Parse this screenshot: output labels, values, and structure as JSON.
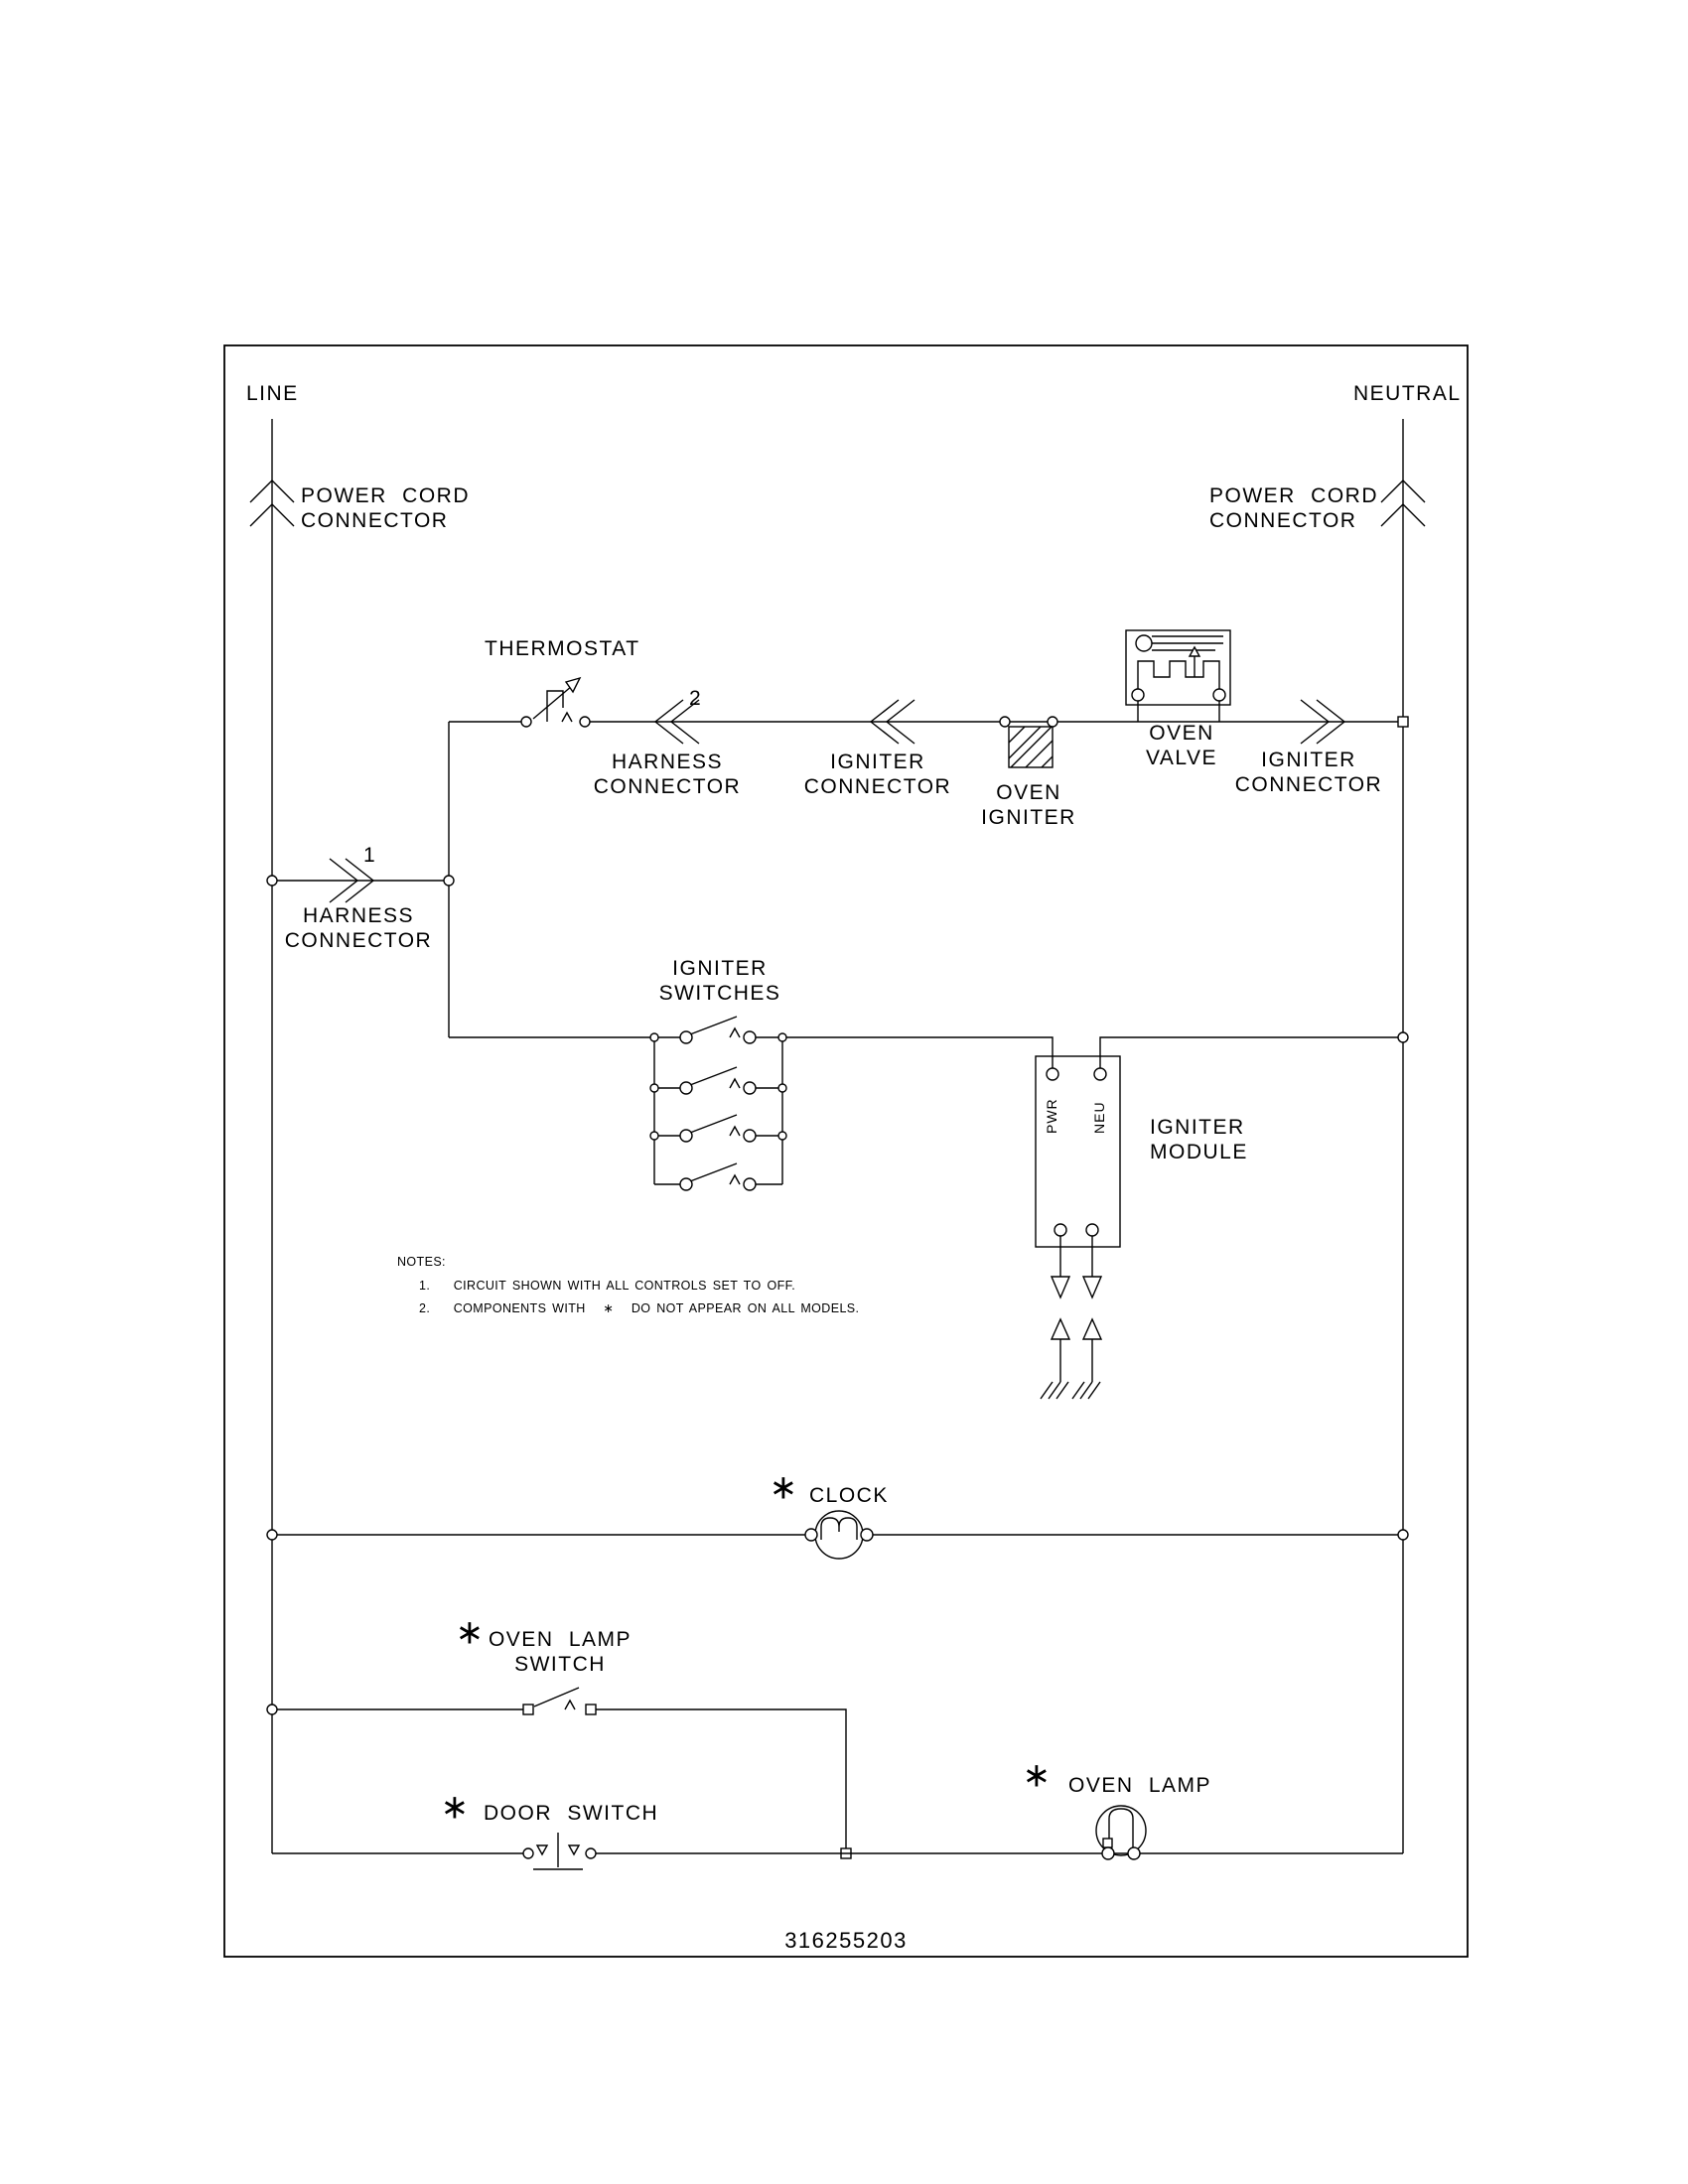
{
  "colors": {
    "ink": "#000000",
    "paper": "#ffffff"
  },
  "symbols": {
    "asterisk": "∗"
  },
  "labels": {
    "line": "LINE",
    "neutral": "NEUTRAL",
    "power_cord_connector": "POWER CORD\nCONNECTOR",
    "thermostat": "THERMOSTAT",
    "connector_ref_2": "2",
    "connector_ref_1": "1",
    "harness_connector": "HARNESS\nCONNECTOR",
    "igniter_connector": "IGNITER\nCONNECTOR",
    "oven_igniter": "OVEN\nIGNITER",
    "oven_valve": "OVEN\nVALVE",
    "igniter_switches": "IGNITER\nSWITCHES",
    "igniter_module": "IGNITER\nMODULE",
    "pwr_terminal": "PWR",
    "neu_terminal": "NEU",
    "clock": "CLOCK",
    "oven_lamp_switch": "OVEN LAMP\nSWITCH",
    "door_switch": "DOOR SWITCH",
    "oven_lamp": "OVEN LAMP"
  },
  "notes": {
    "title": "NOTES:",
    "items": [
      "1.    CIRCUIT SHOWN WITH ALL CONTROLS SET TO OFF.",
      "2.    COMPONENTS WITH   ∗   DO NOT APPEAR ON ALL MODELS."
    ]
  },
  "part_number": "316255203"
}
